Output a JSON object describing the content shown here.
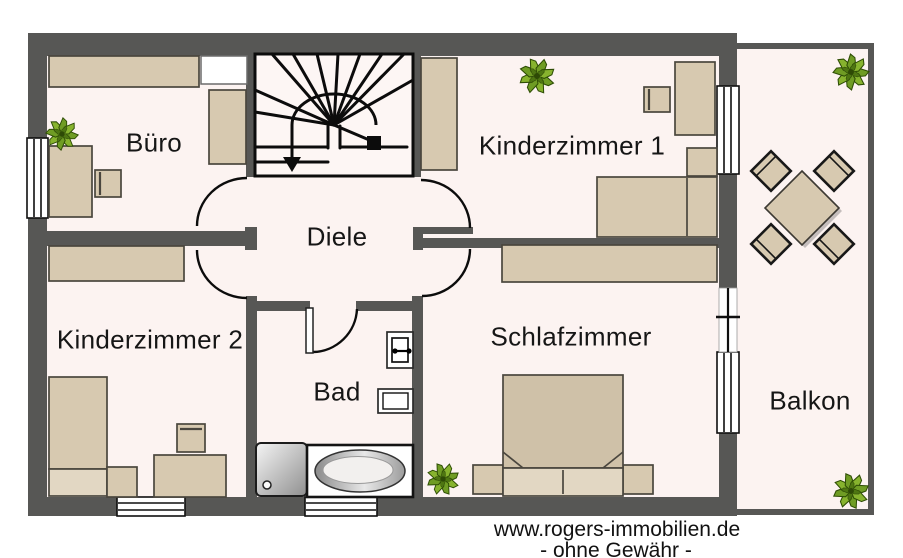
{
  "title": "floor-plan-upper-storey",
  "rooms": {
    "buero": "Büro",
    "kinderzimmer1": "Kinderzimmer 1",
    "diele": "Diele",
    "kinderzimmer2": "Kinderzimmer 2",
    "schlafzimmer": "Schlafzimmer",
    "bad": "Bad",
    "balkon": "Balkon"
  },
  "watermark": {
    "line1": "www.rogers-immobilien.de",
    "line2": "- ohne Gewähr -"
  },
  "colors": {
    "wall": "#575755",
    "floor": "#fcf3f1",
    "furniture": "#d7c9b0",
    "furniture_dark": "#cfc1a8",
    "pillow": "#e2d7c3",
    "plant_green": "#6f9c24",
    "plant_green_light": "#87b32e",
    "outline": "#4a463e",
    "text": "#161616"
  },
  "icons": [
    "plant-icon",
    "stairs-down-arrow-icon",
    "bathtub-icon",
    "shower-icon",
    "toilet-icon",
    "sink-icon",
    "window-icon",
    "door-swing-icon"
  ]
}
